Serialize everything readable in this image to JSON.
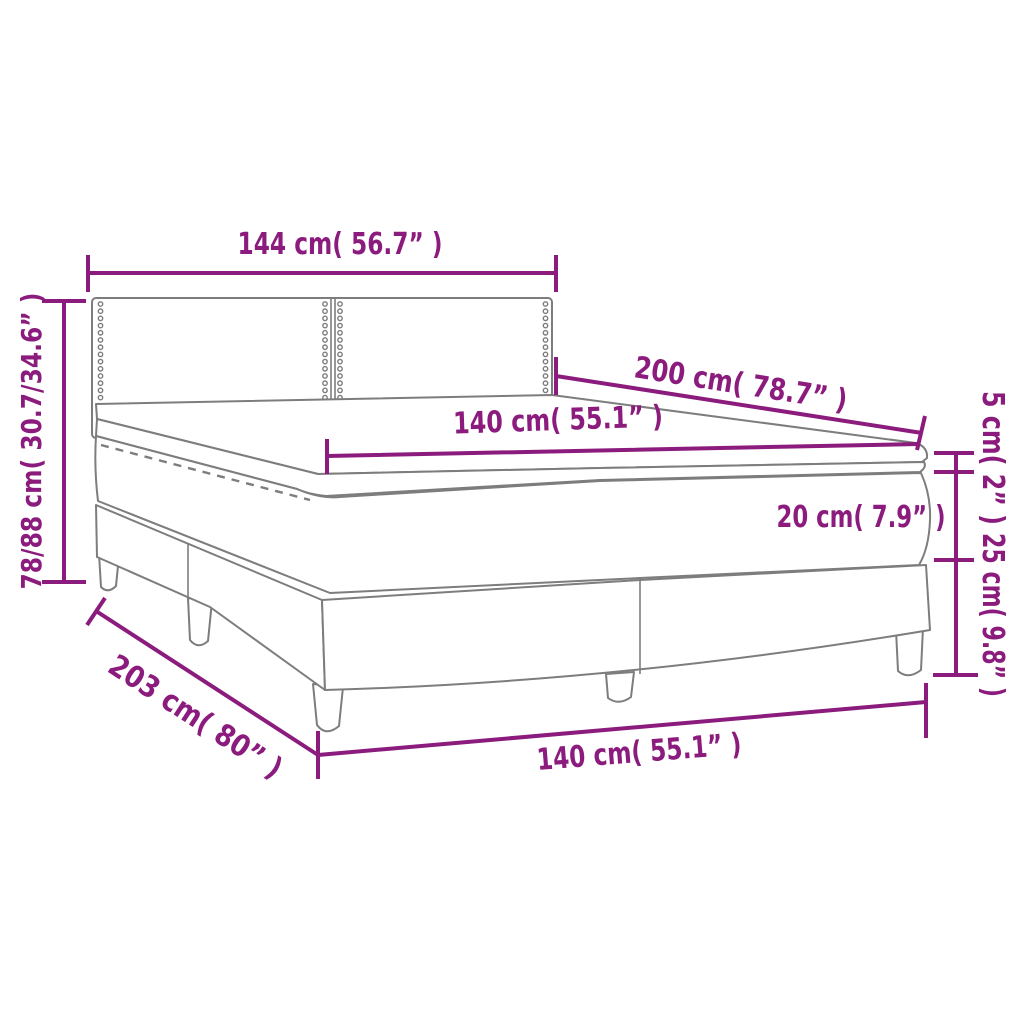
{
  "diagram": {
    "type": "product-dimension-diagram",
    "subject": "box spring bed with headboard, mattress and topper",
    "colors": {
      "accent": "#8B1B7D",
      "outline": "#7d7d7d",
      "background": "#ffffff"
    },
    "labels": {
      "headboard_width": "144 cm( 56.7” )",
      "bed_length": "200 cm( 78.7” )",
      "mattress_width_top": "140 cm( 55.1” )",
      "topper_height": "5 cm( 2” )",
      "mattress_height": "20 cm( 7.9” )",
      "base_height": "25 cm( 9.8” )",
      "frame_height": "78/88 cm( 30.7/34.6” )",
      "total_length": "203 cm( 80” )",
      "mattress_width_bottom": "140 cm( 55.1” )"
    }
  }
}
